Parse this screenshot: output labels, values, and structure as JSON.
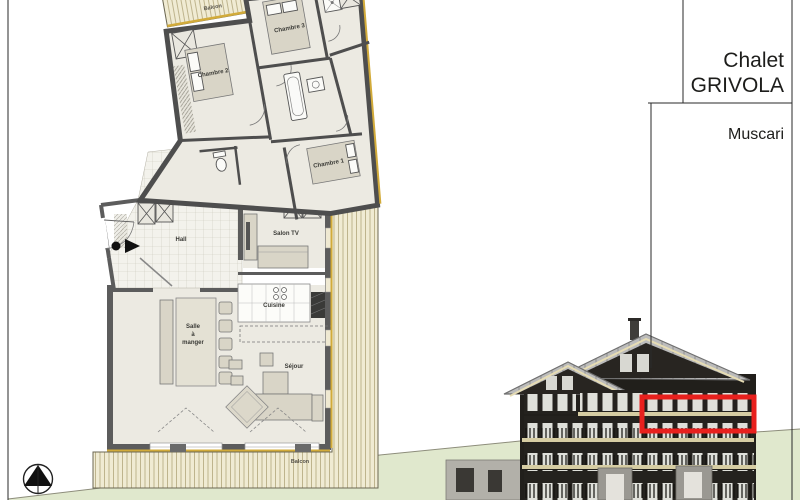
{
  "title_block": {
    "line1": "Chalet",
    "line2": "GRIVOLA",
    "unit": "Muscari"
  },
  "plan": {
    "labels": {
      "balcon_top": "Balcon",
      "chambre_2": "Chambre 2",
      "chambre_3": "Chambre 3",
      "chambre_1": "Chambre 1",
      "hall": "Hall",
      "salon_tv": "Salon TV",
      "cuisine": "Cuisine",
      "salle_lines": [
        "Salle",
        "à",
        "manger"
      ],
      "sejour": "Séjour",
      "balcon_bottom": "Balcon"
    },
    "markers": {
      "entrance": "entrance-arrow",
      "north": "north-compass"
    }
  },
  "elevation": {
    "highlight": "apartment-location-outline"
  },
  "colors": {
    "accent": "#e8201d",
    "gold": "#d2ab3a",
    "wood": "#f0ebd3",
    "wood-line": "#b9ae85",
    "wall": "#5c5c5c",
    "floor": "#eceae2",
    "ground": "#e0e8cd",
    "roof": "#bcbcbc",
    "facade": "#211f1b"
  }
}
